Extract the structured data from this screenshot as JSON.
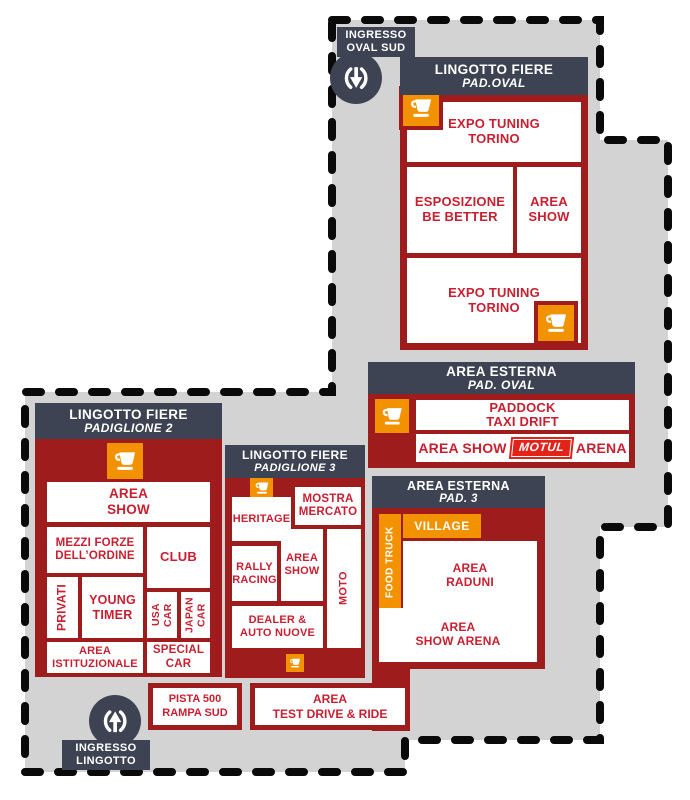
{
  "map": {
    "colors": {
      "block_red": "#9e1c1c",
      "text_red": "#c92031",
      "header_slate": "#3d4353",
      "orange": "#f39200",
      "gray": "#d3d3d3",
      "motul_red": "#e2231a",
      "outline_black": "#0a0a0a"
    },
    "icons": {
      "coffee": "coffee-cup-icon",
      "entrance": "entrance-arrows-icon"
    },
    "entrances": {
      "oval_sud": {
        "l1": "INGRESSO",
        "l2": "OVAL SUD"
      },
      "lingotto": {
        "l1": "INGRESSO",
        "l2": "LINGOTTO"
      }
    },
    "pad_oval": {
      "title": "LINGOTTO FIERE",
      "subtitle": "PAD.OVAL",
      "rooms": {
        "expo_top": {
          "l1": "EXPO TUNING",
          "l2": "TORINO"
        },
        "esposizione": {
          "l1": "ESPOSIZIONE",
          "l2": "BE BETTER"
        },
        "area_show": {
          "l1": "AREA",
          "l2": "SHOW"
        },
        "expo_bottom": {
          "l1": "EXPO TUNING",
          "l2": "TORINO"
        }
      }
    },
    "esterna_oval": {
      "title": "AREA ESTERNA",
      "subtitle": "PAD. OVAL",
      "rooms": {
        "paddock": {
          "l1": "PADDOCK",
          "l2": "TAXI DRIFT"
        },
        "motul": {
          "pre": "AREA SHOW",
          "brand": "MOTUL",
          "post": "ARENA"
        }
      }
    },
    "pad2": {
      "title": "LINGOTTO FIERE",
      "subtitle": "PADIGLIONE 2",
      "rooms": {
        "area_show": {
          "l1": "AREA",
          "l2": "SHOW"
        },
        "mezzi": {
          "l1": "MEZZI FORZE",
          "l2": "DELL’ORDINE"
        },
        "club": {
          "l1": "CLUB"
        },
        "privati": {
          "l1": "PRIVATI"
        },
        "young": {
          "l1": "YOUNG",
          "l2": "TIMER"
        },
        "usa": {
          "l1": "USA",
          "l2": "CAR"
        },
        "japan": {
          "l1": "JAPAN",
          "l2": "CAR"
        },
        "ist": {
          "l1": "AREA",
          "l2": "ISTITUZIONALE"
        },
        "special": {
          "l1": "SPECIAL",
          "l2": "CAR"
        }
      }
    },
    "pad3": {
      "title": "LINGOTTO FIERE",
      "subtitle": "PADIGLIONE 3",
      "rooms": {
        "heritage": {
          "l1": "HERITAGE"
        },
        "mostra": {
          "l1": "MOSTRA",
          "l2": "MERCATO"
        },
        "rally": {
          "l1": "RALLY",
          "l2": "RACING"
        },
        "area_show": {
          "l1": "AREA",
          "l2": "SHOW"
        },
        "moto": {
          "l1": "MOTO"
        },
        "dealer": {
          "l1": "DEALER &",
          "l2": "AUTO NUOVE"
        }
      }
    },
    "esterna_pad3": {
      "title": "AREA ESTERNA",
      "subtitle": "PAD. 3",
      "rooms": {
        "food_truck": {
          "l1": "FOOD TRUCK"
        },
        "village": {
          "l1": "VILLAGE"
        },
        "raduni": {
          "l1": "AREA",
          "l2": "RADUNI"
        },
        "show_arena": {
          "l1": "AREA",
          "l2": "SHOW ARENA"
        }
      }
    },
    "standalone": {
      "pista": {
        "l1": "PISTA 500",
        "l2": "RAMPA SUD"
      },
      "test_drive": {
        "l1": "AREA",
        "l2": "TEST DRIVE & RIDE"
      }
    }
  }
}
